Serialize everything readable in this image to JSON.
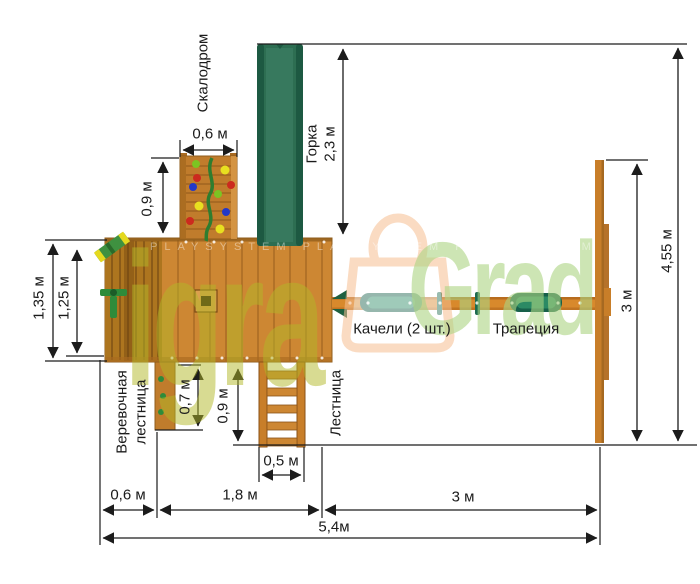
{
  "labels": {
    "climbing_wall": "Скалодром",
    "slide": "Горка",
    "swings": "Качели (2 шт.)",
    "trapeze": "Трапеция",
    "ladder": "Лестница",
    "rope_ladder_line1": "Веревочная",
    "rope_ladder_line2": "лестница"
  },
  "dimensions": {
    "wall_width": "0,6 м",
    "wall_depth": "0,9 м",
    "slide_length": "2,3 м",
    "total_depth": "4,55 м",
    "swing_bay_depth": "3 м",
    "platform_depth_outer": "1,35 м",
    "platform_depth_inner": "1,25 м",
    "rope_ladder_length": "0,7 м",
    "ladder_length": "0,9 м",
    "ladder_width": "0,5 м",
    "bottom_left": "0,6 м",
    "bottom_middle": "1,8 м",
    "bottom_right": "3 м",
    "total_width": "5,4м"
  },
  "watermark": {
    "part1": "igra",
    "part2": "Grad",
    "tm": "PLAYSYSTEM PLAYSYSTEM PLAYSYSTEM"
  },
  "colors": {
    "wood": "#cd8733",
    "deck": "#ad751f",
    "wall": "#c07c2c",
    "beam": "#d8892c",
    "post": "#c87e29",
    "slide_green": "#2d6e52",
    "slide_rail": "#1d5942",
    "seat_dark": "#17604a",
    "seat_teal": "#2b8a64",
    "accent_green": "#2e8b3a",
    "vine": "#2f7d2f",
    "hold_red": "#cc2a1e",
    "hold_blue": "#2438c8",
    "hold_yellow": "#e8e020",
    "hold_green": "#7cc422",
    "dim": "#1c1c1c",
    "wm_yellow": "#b2b828",
    "wm_green": "#acd583",
    "wm_peach": "#f6bf92"
  }
}
